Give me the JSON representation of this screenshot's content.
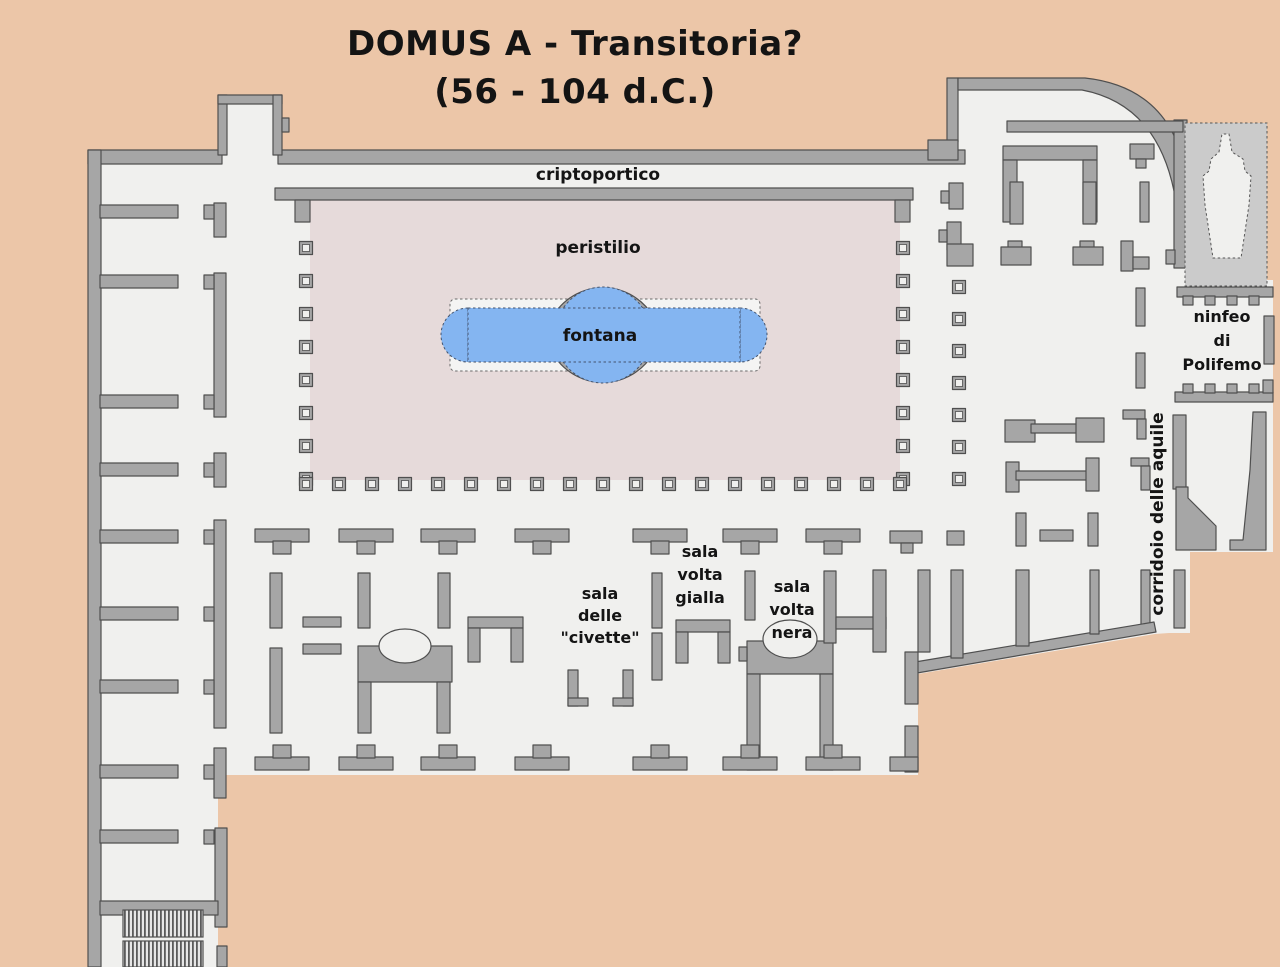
{
  "title": {
    "line1": "DOMUS A  - Transitoria?",
    "line2": "(56 - 104 d.C.)"
  },
  "labels": {
    "criptoportico": "criptoportico",
    "peristilio": "peristilio",
    "fontana": "fontana",
    "sala_civette": [
      "sala",
      "delle",
      "\"civette\""
    ],
    "sala_volta_gialla": [
      "sala",
      "volta",
      "gialla"
    ],
    "sala_volta_nera": [
      "sala",
      "volta",
      "nera"
    ],
    "ninfeo_polifemo": [
      "ninfeo",
      "di",
      "Polifemo"
    ],
    "corridoio": "corridoio delle aquile"
  },
  "colors": {
    "background": "#ecc6a8",
    "floor": "#f0f0ee",
    "wall": "#a6a6a6",
    "wall_stroke": "#4f4f4f",
    "courtyard": "#e6dada",
    "water": "#84b5f1",
    "water_edge": "#44546e",
    "niche_area": "#cbcbcb",
    "ink": "#141414"
  }
}
